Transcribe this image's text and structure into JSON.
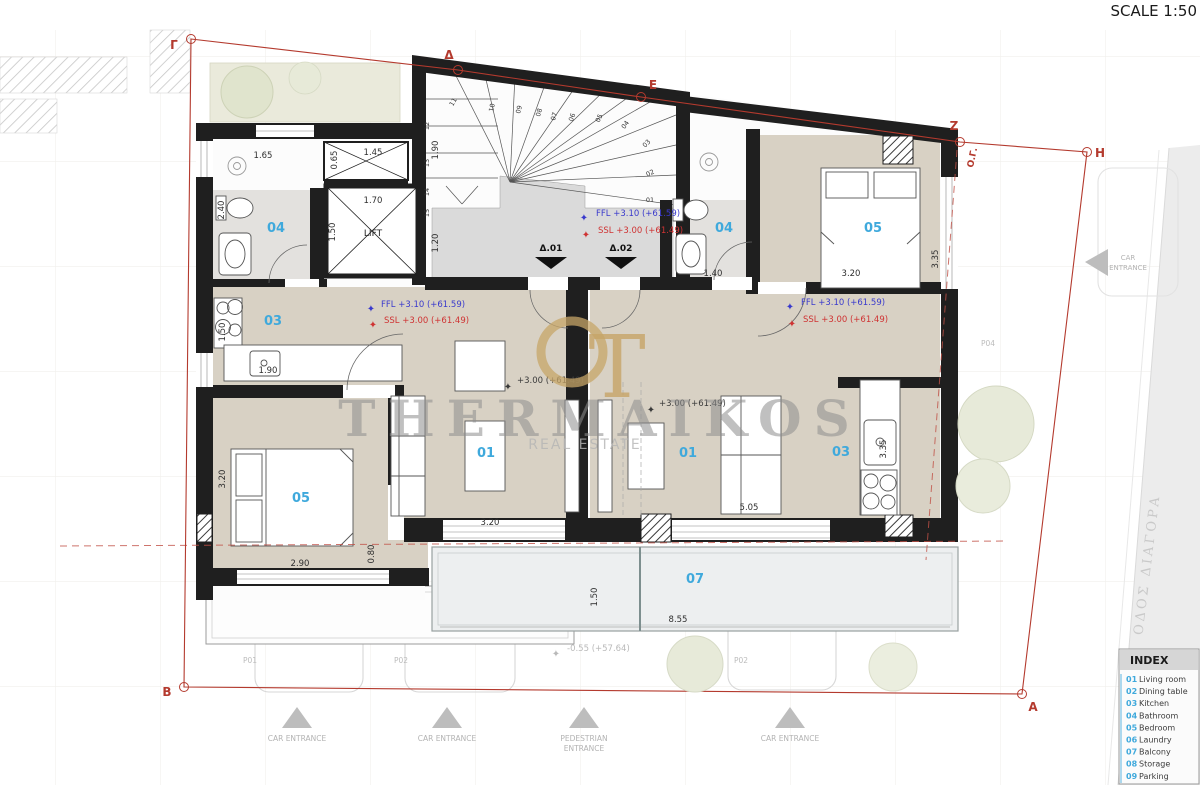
{
  "title": {
    "scale_label": "SCALE 1:50"
  },
  "watermark": {
    "name": "THERMAIKOS",
    "subtitle": "REAL ESTATE",
    "monogram": "T"
  },
  "colors": {
    "accent_cyan": "#3fa9dc",
    "boundary_red": "#b43a2e",
    "ffl_blue": "#3a3acc",
    "ssl_red": "#cf3333",
    "wall_black": "#1f1f1f",
    "floor_beige": "#d8d1c4",
    "bath_gray": "#e3e1de",
    "balcony_gray": "#edeff0",
    "logo_gold": "#c7a568",
    "muted_gray": "#b3b3b3"
  },
  "plan": {
    "lift_label": "LIFT",
    "building_line_label": "Ο.Γ.",
    "street_label": "ΟΔΟΣ ΔΙΑΓΟΡΑ",
    "door_labels": [
      {
        "t": "Δ.01",
        "x": 551,
        "y": 251
      },
      {
        "t": "Δ.02",
        "x": 621,
        "y": 251
      }
    ],
    "room_labels": [
      {
        "t": "04",
        "x": 276,
        "y": 232
      },
      {
        "t": "03",
        "x": 273,
        "y": 325
      },
      {
        "t": "05",
        "x": 301,
        "y": 502
      },
      {
        "t": "01",
        "x": 486,
        "y": 457
      },
      {
        "t": "01",
        "x": 688,
        "y": 457
      },
      {
        "t": "03",
        "x": 841,
        "y": 456
      },
      {
        "t": "04",
        "x": 724,
        "y": 232
      },
      {
        "t": "05",
        "x": 873,
        "y": 232
      },
      {
        "t": "07",
        "x": 695,
        "y": 583
      }
    ],
    "dimensions": [
      {
        "t": "1.65",
        "x": 263,
        "y": 158
      },
      {
        "t": "0.65",
        "x": 337,
        "y": 160,
        "r": -90
      },
      {
        "t": "1.45",
        "x": 373,
        "y": 155
      },
      {
        "t": "2.40",
        "x": 224,
        "y": 210,
        "r": -90
      },
      {
        "t": "1.70",
        "x": 373,
        "y": 203
      },
      {
        "t": "1.50",
        "x": 335,
        "y": 232,
        "r": -90
      },
      {
        "t": "1.90",
        "x": 438,
        "y": 150,
        "r": -90
      },
      {
        "t": "1.20",
        "x": 438,
        "y": 243,
        "r": -90
      },
      {
        "t": "1.50",
        "x": 225,
        "y": 332,
        "r": -90
      },
      {
        "t": "1.90",
        "x": 268,
        "y": 373
      },
      {
        "t": "3.20",
        "x": 490,
        "y": 525
      },
      {
        "t": "3.20",
        "x": 225,
        "y": 479,
        "r": -90
      },
      {
        "t": "2.90",
        "x": 300,
        "y": 566
      },
      {
        "t": "0.80",
        "x": 374,
        "y": 554,
        "r": -90
      },
      {
        "t": "3.20",
        "x": 851,
        "y": 276
      },
      {
        "t": "3.35",
        "x": 938,
        "y": 259,
        "r": -90
      },
      {
        "t": "1.40",
        "x": 713,
        "y": 276
      },
      {
        "t": "5.05",
        "x": 749,
        "y": 510
      },
      {
        "t": "3.35",
        "x": 886,
        "y": 449,
        "r": -90
      },
      {
        "t": "1.50",
        "x": 597,
        "y": 597,
        "r": -90
      },
      {
        "t": "8.55",
        "x": 678,
        "y": 622
      }
    ],
    "stair_treads": [
      {
        "t": "01",
        "x": 650,
        "y": 202,
        "r": 0
      },
      {
        "t": "02",
        "x": 651,
        "y": 175,
        "r": -25
      },
      {
        "t": "03",
        "x": 648,
        "y": 145,
        "r": -45
      },
      {
        "t": "04",
        "x": 627,
        "y": 126,
        "r": -55
      },
      {
        "t": "05",
        "x": 601,
        "y": 119,
        "r": -65
      },
      {
        "t": "06",
        "x": 574,
        "y": 118,
        "r": -70
      },
      {
        "t": "07",
        "x": 556,
        "y": 117,
        "r": -72
      },
      {
        "t": "08",
        "x": 541,
        "y": 113,
        "r": -74
      },
      {
        "t": "09",
        "x": 521,
        "y": 110,
        "r": -76
      },
      {
        "t": "10",
        "x": 494,
        "y": 108,
        "r": -78
      },
      {
        "t": "11",
        "x": 455,
        "y": 103,
        "r": -60
      },
      {
        "t": "12",
        "x": 429,
        "y": 126,
        "r": -90
      },
      {
        "t": "13",
        "x": 429,
        "y": 163,
        "r": -90
      },
      {
        "t": "14",
        "x": 429,
        "y": 192,
        "r": -90
      },
      {
        "t": "15",
        "x": 429,
        "y": 213,
        "r": -90
      }
    ],
    "levels": [
      {
        "t": "FFL +3.10 (+61.59)",
        "x": 596,
        "y": 216,
        "c": "blue",
        "star": [
          584,
          221
        ]
      },
      {
        "t": "SSL +3.00 (+61.49)",
        "x": 598,
        "y": 233,
        "c": "red",
        "star": [
          586,
          238
        ]
      },
      {
        "t": "FFL +3.10 (+61.59)",
        "x": 381,
        "y": 307,
        "c": "blue",
        "star": [
          371,
          312
        ]
      },
      {
        "t": "SSL +3.00 (+61.49)",
        "x": 384,
        "y": 323,
        "c": "red",
        "star": [
          373,
          328
        ]
      },
      {
        "t": "FFL +3.10 (+61.59)",
        "x": 801,
        "y": 305,
        "c": "blue",
        "star": [
          790,
          310
        ]
      },
      {
        "t": "SSL +3.00 (+61.49)",
        "x": 803,
        "y": 322,
        "c": "red",
        "star": [
          792,
          327
        ]
      },
      {
        "t": "+3.00 (+61.49)",
        "x": 517,
        "y": 383,
        "c": "dark",
        "star": [
          508,
          390
        ]
      },
      {
        "t": "+3.00 (+61.49)",
        "x": 659,
        "y": 406,
        "c": "dark",
        "star": [
          651,
          413
        ]
      },
      {
        "t": "-0.55 (+57.64)",
        "x": 567,
        "y": 651,
        "c": "faint",
        "star": [
          556,
          657
        ]
      }
    ],
    "parking_labels": [
      {
        "t": "P01",
        "x": 243,
        "y": 663
      },
      {
        "t": "P02",
        "x": 394,
        "y": 663
      },
      {
        "t": "P02",
        "x": 734,
        "y": 663
      },
      {
        "t": "P04",
        "x": 981,
        "y": 346
      }
    ],
    "boundary_vertices": [
      {
        "t": "Γ",
        "x": 174,
        "y": 49,
        "cx": 191,
        "cy": 39
      },
      {
        "t": "Δ",
        "x": 449,
        "y": 59,
        "cx": 458,
        "cy": 70
      },
      {
        "t": "E",
        "x": 653,
        "y": 89,
        "cx": 641,
        "cy": 97
      },
      {
        "t": "Z",
        "x": 954,
        "y": 130,
        "cx": 960,
        "cy": 142
      },
      {
        "t": "H",
        "x": 1100,
        "y": 157,
        "cx": 1087,
        "cy": 152
      },
      {
        "t": "A",
        "x": 1033,
        "y": 711,
        "cx": 1022,
        "cy": 694
      },
      {
        "t": "B",
        "x": 167,
        "y": 696,
        "cx": 184,
        "cy": 687
      }
    ],
    "entrances_bottom": [
      {
        "lines": [
          "CAR ENTRANCE"
        ],
        "x": 297
      },
      {
        "lines": [
          "CAR ENTRANCE"
        ],
        "x": 447
      },
      {
        "lines": [
          "PEDESTRIAN",
          "ENTRANCE"
        ],
        "x": 584
      },
      {
        "lines": [
          "CAR ENTRANCE"
        ],
        "x": 790
      }
    ],
    "side_entrance": {
      "lines": [
        "CAR",
        "ENTRANCE"
      ]
    }
  },
  "index_panel": {
    "title": "INDEX",
    "items": [
      {
        "num": "01",
        "label": "Living room"
      },
      {
        "num": "02",
        "label": "Dining table"
      },
      {
        "num": "03",
        "label": "Kitchen"
      },
      {
        "num": "04",
        "label": "Bathroom"
      },
      {
        "num": "05",
        "label": "Bedroom"
      },
      {
        "num": "06",
        "label": "Laundry"
      },
      {
        "num": "07",
        "label": "Balcony"
      },
      {
        "num": "08",
        "label": "Storage"
      },
      {
        "num": "09",
        "label": "Parking"
      }
    ]
  }
}
